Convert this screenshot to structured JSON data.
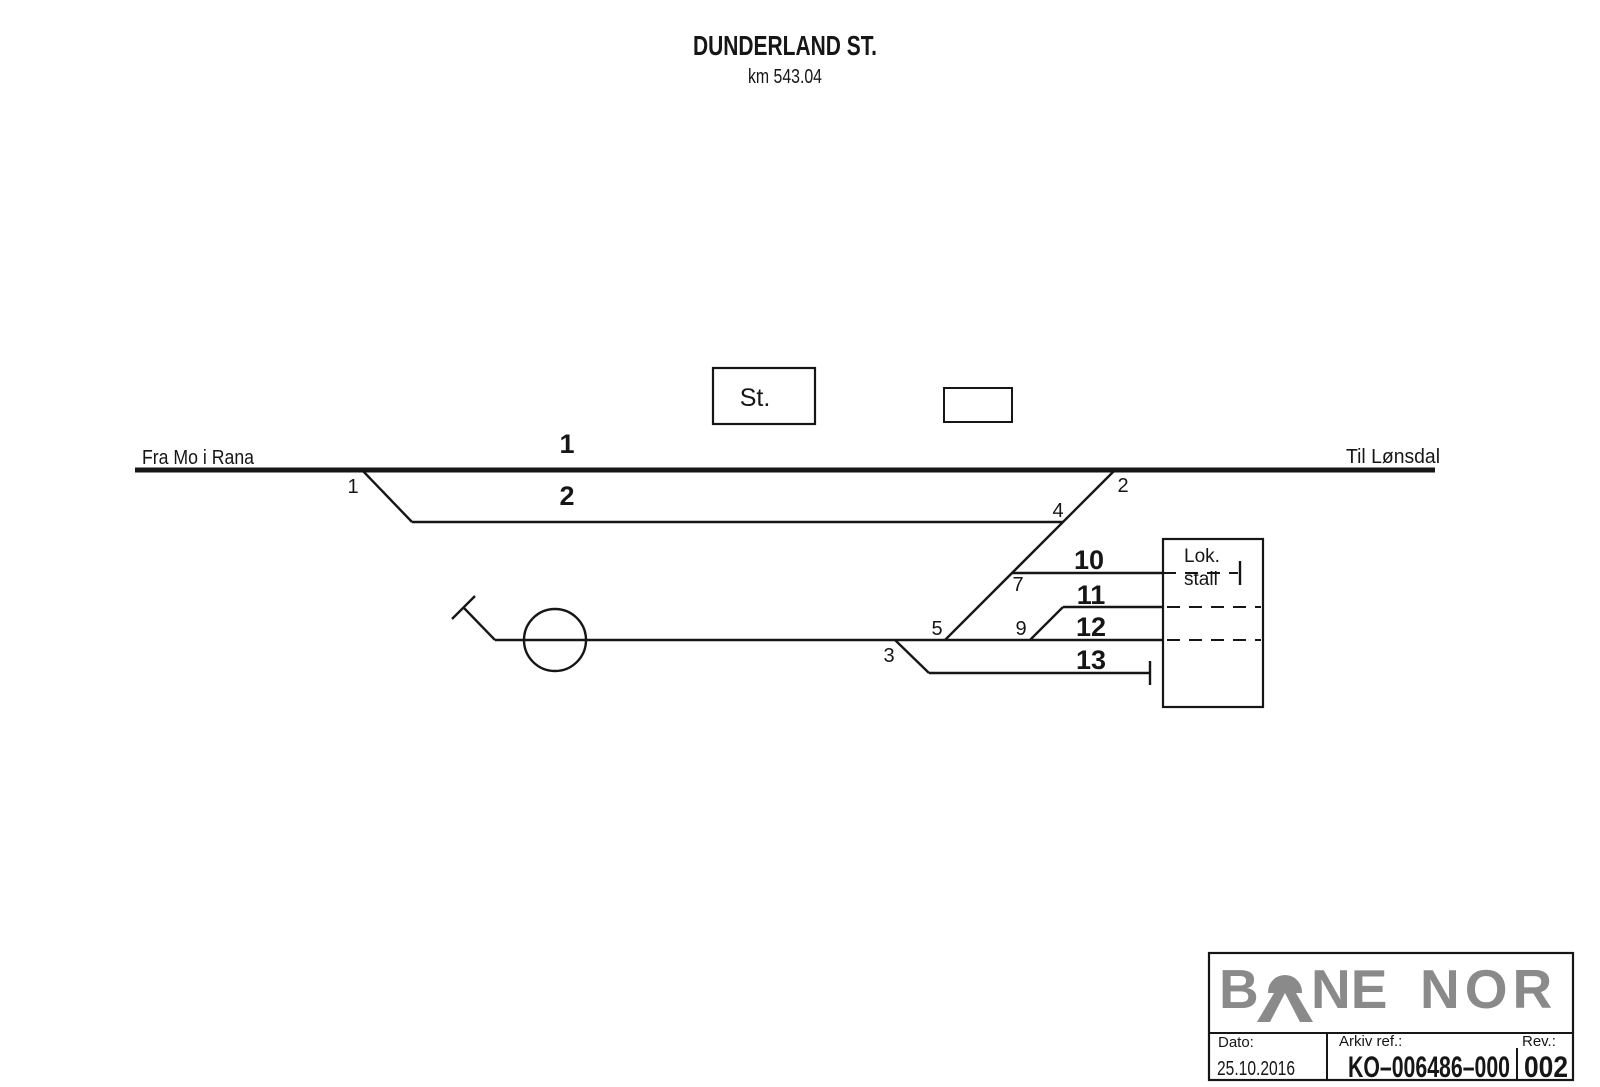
{
  "station": {
    "name": "DUNDERLAND ST.",
    "km": "km 543.04"
  },
  "directions": {
    "from": "Fra Mo i Rana",
    "to": "Til Lønsdal"
  },
  "buildings": {
    "station_box": "St.",
    "loco_shed_line1": "Lok.",
    "loco_shed_line2": "stall"
  },
  "tracks": {
    "t1": "1",
    "t2": "2",
    "t10": "10",
    "t11": "11",
    "t12": "12",
    "t13": "13"
  },
  "switches": {
    "s1": "1",
    "s2": "2",
    "s3": "3",
    "s4": "4",
    "s5": "5",
    "s7": "7",
    "s9": "9"
  },
  "title_block": {
    "logo_left": "B",
    "logo_mid": "NE",
    "logo_right": "NOR",
    "date_label": "Dato:",
    "date_value": "25.10.2016",
    "archive_label": "Arkiv ref.:",
    "archive_value": "KO–006486–000",
    "rev_label": "Rev.:",
    "rev_value": "002"
  },
  "colors": {
    "ink": "#161616",
    "logo_gray": "#8a8a8a",
    "background": "#ffffff"
  }
}
